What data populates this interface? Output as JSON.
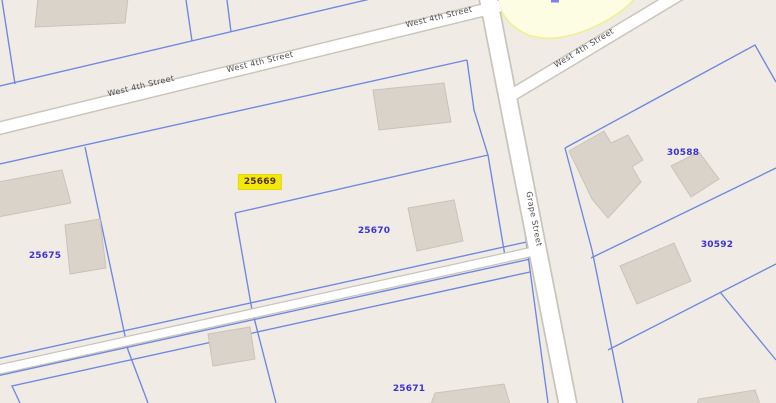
{
  "map": {
    "selected_parcel": "25669",
    "colors": {
      "background": "#f0ece5",
      "parcel_line": "#6e87e0",
      "parcel_label": "#3c34d2",
      "street_label": "#4e4e4e",
      "road_fill": "#ffffff",
      "road_casing": "#c9c5bc",
      "building_fill": "#d9d3ca",
      "highlight_background": "#f3e80b",
      "highlight_text": "#53300e",
      "zone_fill": "#fdfde4",
      "zone_border": "#eef08c"
    },
    "parcels": [
      {
        "id": "25669",
        "highlighted": true
      },
      {
        "id": "25670",
        "highlighted": false
      },
      {
        "id": "25675",
        "highlighted": false
      },
      {
        "id": "25671",
        "highlighted": false
      },
      {
        "id": "30588",
        "highlighted": false
      },
      {
        "id": "30592",
        "highlighted": false
      }
    ],
    "streets": [
      {
        "name": "West 4th Street"
      },
      {
        "name": "West 4th Street"
      },
      {
        "name": "West 4th Street"
      },
      {
        "name": "West 4th Street"
      },
      {
        "name": "Grape Street"
      }
    ]
  }
}
